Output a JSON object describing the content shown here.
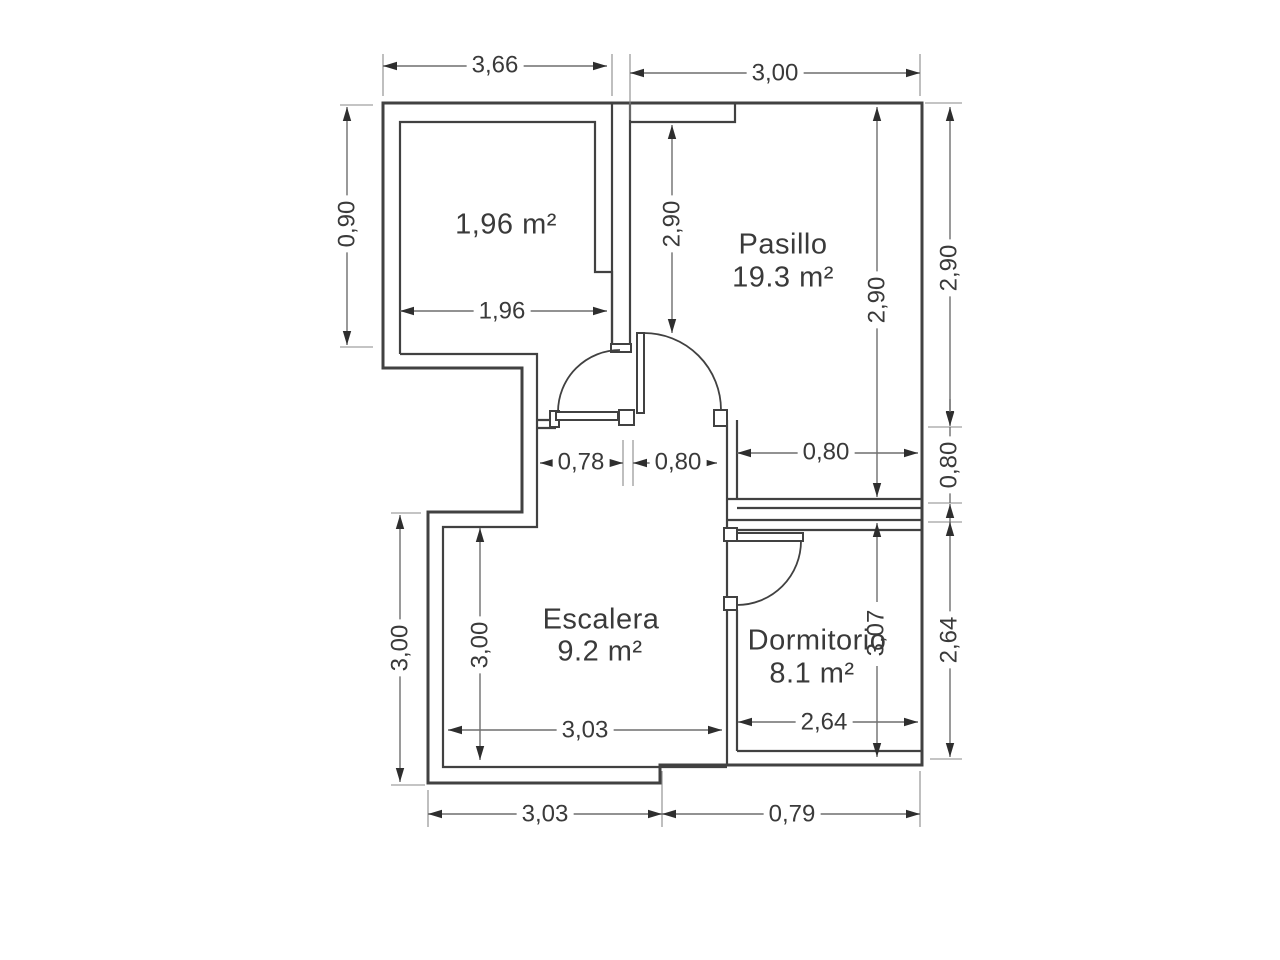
{
  "floorplan": {
    "rooms": {
      "storage": {
        "area": "1,96 m²"
      },
      "pasillo": {
        "name": "Pasillo",
        "area": "19.3 m²"
      },
      "escalera": {
        "name": "Escalera",
        "area": "9.2 m²"
      },
      "dormitorio": {
        "name": "Dormitorio",
        "area": "8.1 m²"
      }
    },
    "dims": {
      "top_width_left": "3,66",
      "top_width_right": "3,00",
      "left_height_top": "0,90",
      "storage_width": "1,96",
      "pasillo_inner_height_left": "2,90",
      "pasillo_inner_height_right": "2,90",
      "right_height_top": "2,90",
      "door_left_opening": "0,78",
      "door_mid_opening": "0,80",
      "passage_right": "0,80",
      "right_opening": "0,80",
      "left_height_bottom": "3,00",
      "escalera_inner_height": "3,00",
      "escalera_inner_width": "3,03",
      "bottom_width_left": "3,03",
      "bottom_width_right": "0,79",
      "dormitorio_inner_height": "3,07",
      "dormitorio_inner_width": "2,64",
      "right_height_bottom": "2,64"
    },
    "colors": {
      "wall": "#414141",
      "dimension_line": "#6e6e6e",
      "text": "#3a3a3a"
    }
  }
}
